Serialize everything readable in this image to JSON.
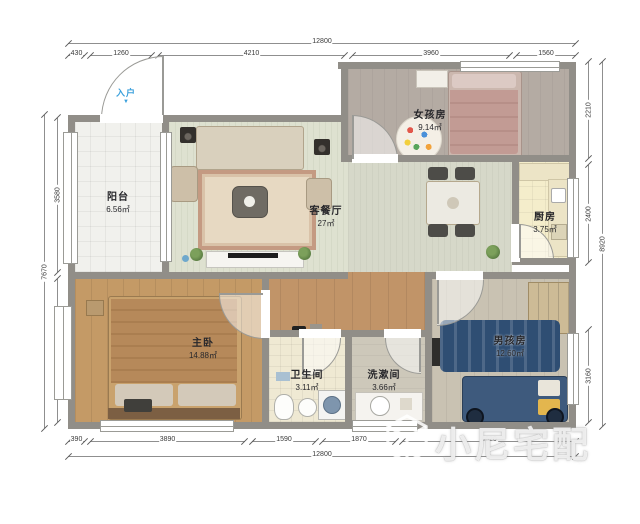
{
  "watermark": {
    "text": "小尼宅配"
  },
  "entry": {
    "label": "入户",
    "arrow": "▼"
  },
  "rooms": {
    "balcony": {
      "name": "阳台",
      "area": "6.56㎡"
    },
    "living": {
      "name": "客餐厅",
      "area": "27㎡"
    },
    "girl": {
      "name": "女孩房",
      "area": "9.14㎡"
    },
    "kitchen": {
      "name": "厨房",
      "area": "3.75㎡"
    },
    "master": {
      "name": "主卧",
      "area": "14.88㎡"
    },
    "bath": {
      "name": "卫生间",
      "area": "3.11㎡"
    },
    "wash": {
      "name": "洗漱间",
      "area": "3.66㎡"
    },
    "boy": {
      "name": "男孩房",
      "area": "12.60㎡"
    }
  },
  "dimensions": {
    "top": {
      "total": "12800",
      "segments": [
        "430",
        "1260",
        "4210",
        "3960",
        "1560"
      ]
    },
    "bottom": {
      "total": "12800",
      "segments": [
        "390",
        "3890",
        "1590",
        "1870",
        "4620"
      ]
    },
    "left": {
      "total": "7670",
      "segments": [
        "3580",
        "3110"
      ]
    },
    "right": {
      "total": "8920",
      "segments": [
        "2210",
        "2400",
        "3160"
      ]
    }
  },
  "colors": {
    "wall": "#918e88",
    "entry_blue": "#3aa0dc",
    "wood_floor": "#c49a66",
    "boy_navy": "#3e5a7d"
  }
}
